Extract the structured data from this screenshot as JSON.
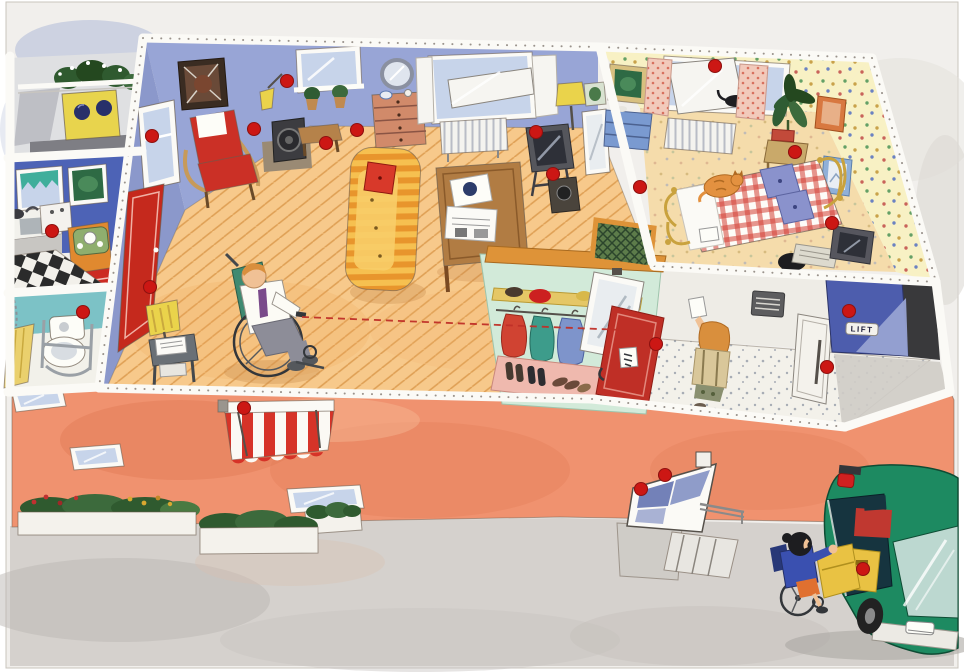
{
  "labels": {
    "lift_sign": "LIFT"
  },
  "palette": {
    "paper": "#f1efec",
    "sky_wash": "#a9b6d6",
    "rim_white": "#fbfaf6",
    "facade": "#f0926f",
    "facade_shade": "#e17a55",
    "living_wall": "#98a5d6",
    "living_wall_dark": "#8b98cb",
    "living_floor": "#f7c98b",
    "floor_line": "#dfa055",
    "door_red": "#c5291d",
    "armchair_red": "#cb3026",
    "sofa_yellow": "#f6c050",
    "sofa_stripe": "#e8952c",
    "pillow_red": "#d8392a",
    "table_wood": "#b17c43",
    "tv_gray": "#55565c",
    "lamp_yellow": "#ead34b",
    "kitchen_wall": "#4d63b6",
    "counter_orange": "#e0892f",
    "drawer_red": "#cc2b22",
    "checker_dark": "#2b2b2b",
    "teal_curtain": "#3fae9b",
    "toilet_wall": "#7cc2c6",
    "towel_yellow": "#ead06d",
    "bedroom_wall": "#f8f1c4",
    "bedroom_floor": "#f5dcab",
    "gingham": "#d23f35",
    "pillow_blue": "#8a92cc",
    "cat_orange": "#e39140",
    "gold": "#c9a23e",
    "plant_green": "#2f5c33",
    "curtain_pink": "#f2cabb",
    "closet_mint": "#d2ead9",
    "closet_wood": "#de9338",
    "shelf_yellow": "#e5c766",
    "coat_red": "#d04332",
    "coat_teal": "#3d9c8b",
    "coat_blue": "#7e94cb",
    "mat_pink": "#efb9ae",
    "cabinet_red": "#bf2f26",
    "hall_wall": "#eeece6",
    "hall_floor": "#f3f1ea",
    "elevator_blue": "#4d5dad",
    "elevator_sheen": "#97a2d2",
    "elevator_frame": "#39393b",
    "awning_red": "#d63328",
    "sidewalk": "#d5d1cd",
    "shade_gray": "#bcb7b3",
    "van_green": "#1d8a61",
    "van_dark": "#16343f",
    "van_sheen": "#bcd8d0",
    "ramp_yellow": "#e9c243",
    "skin": "#f0c195",
    "hair_orange": "#d98f3d",
    "hair_black": "#1d1d20",
    "shirt_white": "#fcfbf5",
    "pants_gray": "#8d8d98",
    "chair_green": "#3f8a71",
    "glass_blue": "#c7d4ea",
    "marker_red": "#cc1714",
    "line_red": "#c03028",
    "bush_green": "#2f5a2f",
    "flower_red": "#c03030",
    "flower_yellow": "#d8a830"
  },
  "sight_line": {
    "x1": 302,
    "y1": 317,
    "x2": 648,
    "y2": 331
  },
  "markers": [
    [
      152,
      136
    ],
    [
      254,
      129
    ],
    [
      287,
      81
    ],
    [
      326,
      143
    ],
    [
      357,
      130
    ],
    [
      536,
      132
    ],
    [
      553,
      174
    ],
    [
      715,
      66
    ],
    [
      640,
      187
    ],
    [
      795,
      152
    ],
    [
      832,
      223
    ],
    [
      656,
      344
    ],
    [
      849,
      311
    ],
    [
      827,
      367
    ],
    [
      665,
      475
    ],
    [
      641,
      489
    ],
    [
      863,
      569
    ],
    [
      52,
      231
    ],
    [
      83,
      312
    ],
    [
      150,
      287
    ],
    [
      244,
      408
    ]
  ]
}
